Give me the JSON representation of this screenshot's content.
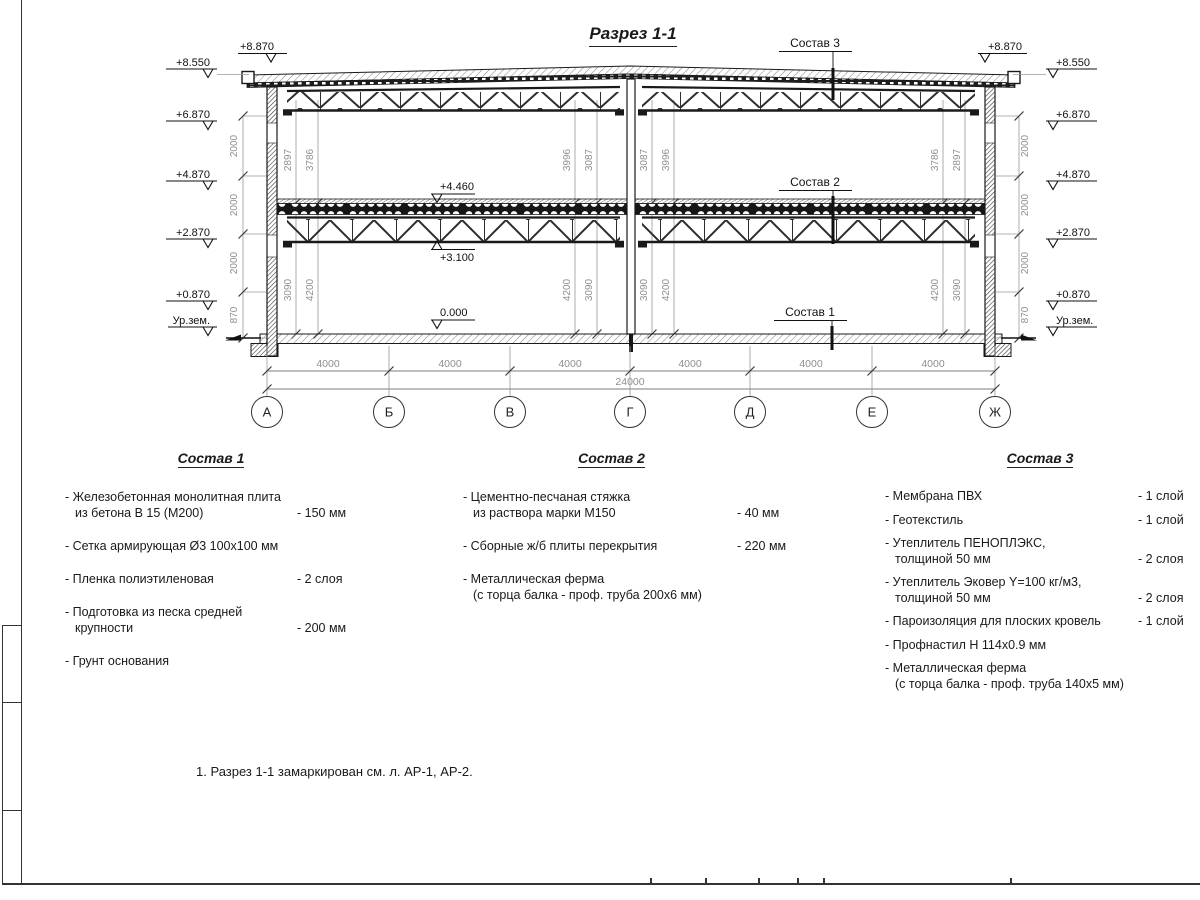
{
  "sheet": {
    "title": "Разрез 1-1",
    "note": "1. Разрез 1-1 замаркирован см. л. АР-1, АР-2."
  },
  "section": {
    "marks": {
      "m8870": "+8.870",
      "m8550": "+8.550",
      "m6870": "+6.870",
      "m4870": "+4.870",
      "m2870": "+2.870",
      "m0870": "+0.870",
      "ground": "Ур.зем.",
      "floor2": "+4.460",
      "truss_bottom": "+3.100",
      "zero": "0.000"
    },
    "layer_labels": {
      "c1": "Состав 1",
      "c2": "Состав 2",
      "c3": "Состав 3"
    },
    "chain": [
      "2000",
      "2000",
      "2000",
      "870"
    ],
    "vdims": {
      "upper": [
        "2897",
        "3786",
        "3996",
        "3087",
        "3087",
        "3996",
        "3786",
        "2897"
      ],
      "lower": [
        "3090",
        "4200",
        "4200",
        "3090",
        "3090",
        "4200",
        "4200",
        "3090"
      ]
    },
    "axes": {
      "labels": [
        "А",
        "Б",
        "В",
        "Г",
        "Д",
        "Е",
        "Ж"
      ],
      "bay": "4000",
      "total": "24000"
    }
  },
  "compositions": [
    {
      "title": "Состав 1",
      "items": [
        {
          "name": "- Железобетонная монолитная плита\nиз бетона В 15 (М200)",
          "value": "- 150 мм"
        },
        {
          "name": "- Сетка армирующая Ø3 100х100 мм",
          "value": ""
        },
        {
          "name": "- Пленка полиэтиленовая",
          "value": "-  2 слоя"
        },
        {
          "name": "- Подготовка из песка средней\nкрупности",
          "value": "- 200 мм"
        },
        {
          "name": "- Грунт основания",
          "value": ""
        }
      ]
    },
    {
      "title": "Состав 2",
      "items": [
        {
          "name": "- Цементно-песчаная стяжка\nиз раствора марки М150",
          "value": "- 40 мм"
        },
        {
          "name": "- Сборные ж/б плиты перекрытия",
          "value": "- 220 мм"
        },
        {
          "name": "- Металлическая ферма\n(с торца балка - проф. труба 200х6 мм)",
          "value": ""
        }
      ]
    },
    {
      "title": "Состав 3",
      "items": [
        {
          "name": "- Мембрана ПВХ",
          "value": "- 1 слой"
        },
        {
          "name": "- Геотекстиль",
          "value": "- 1 слой"
        },
        {
          "name": "- Утеплитель ПЕНОПЛЭКС,\nтолщиной 50 мм",
          "value": "- 2 слоя"
        },
        {
          "name": "- Утеплитель Эковер Y=100 кг/м3,\nтолщиной 50 мм",
          "value": "- 2 слоя"
        },
        {
          "name": "- Пароизоляция для плоских кровель",
          "value": "- 1 слой"
        },
        {
          "name": "- Профнастил Н 114х0.9 мм",
          "value": ""
        },
        {
          "name": "- Металлическая ферма\n(с торца балка - проф. труба 140х5 мм)",
          "value": ""
        }
      ]
    }
  ]
}
